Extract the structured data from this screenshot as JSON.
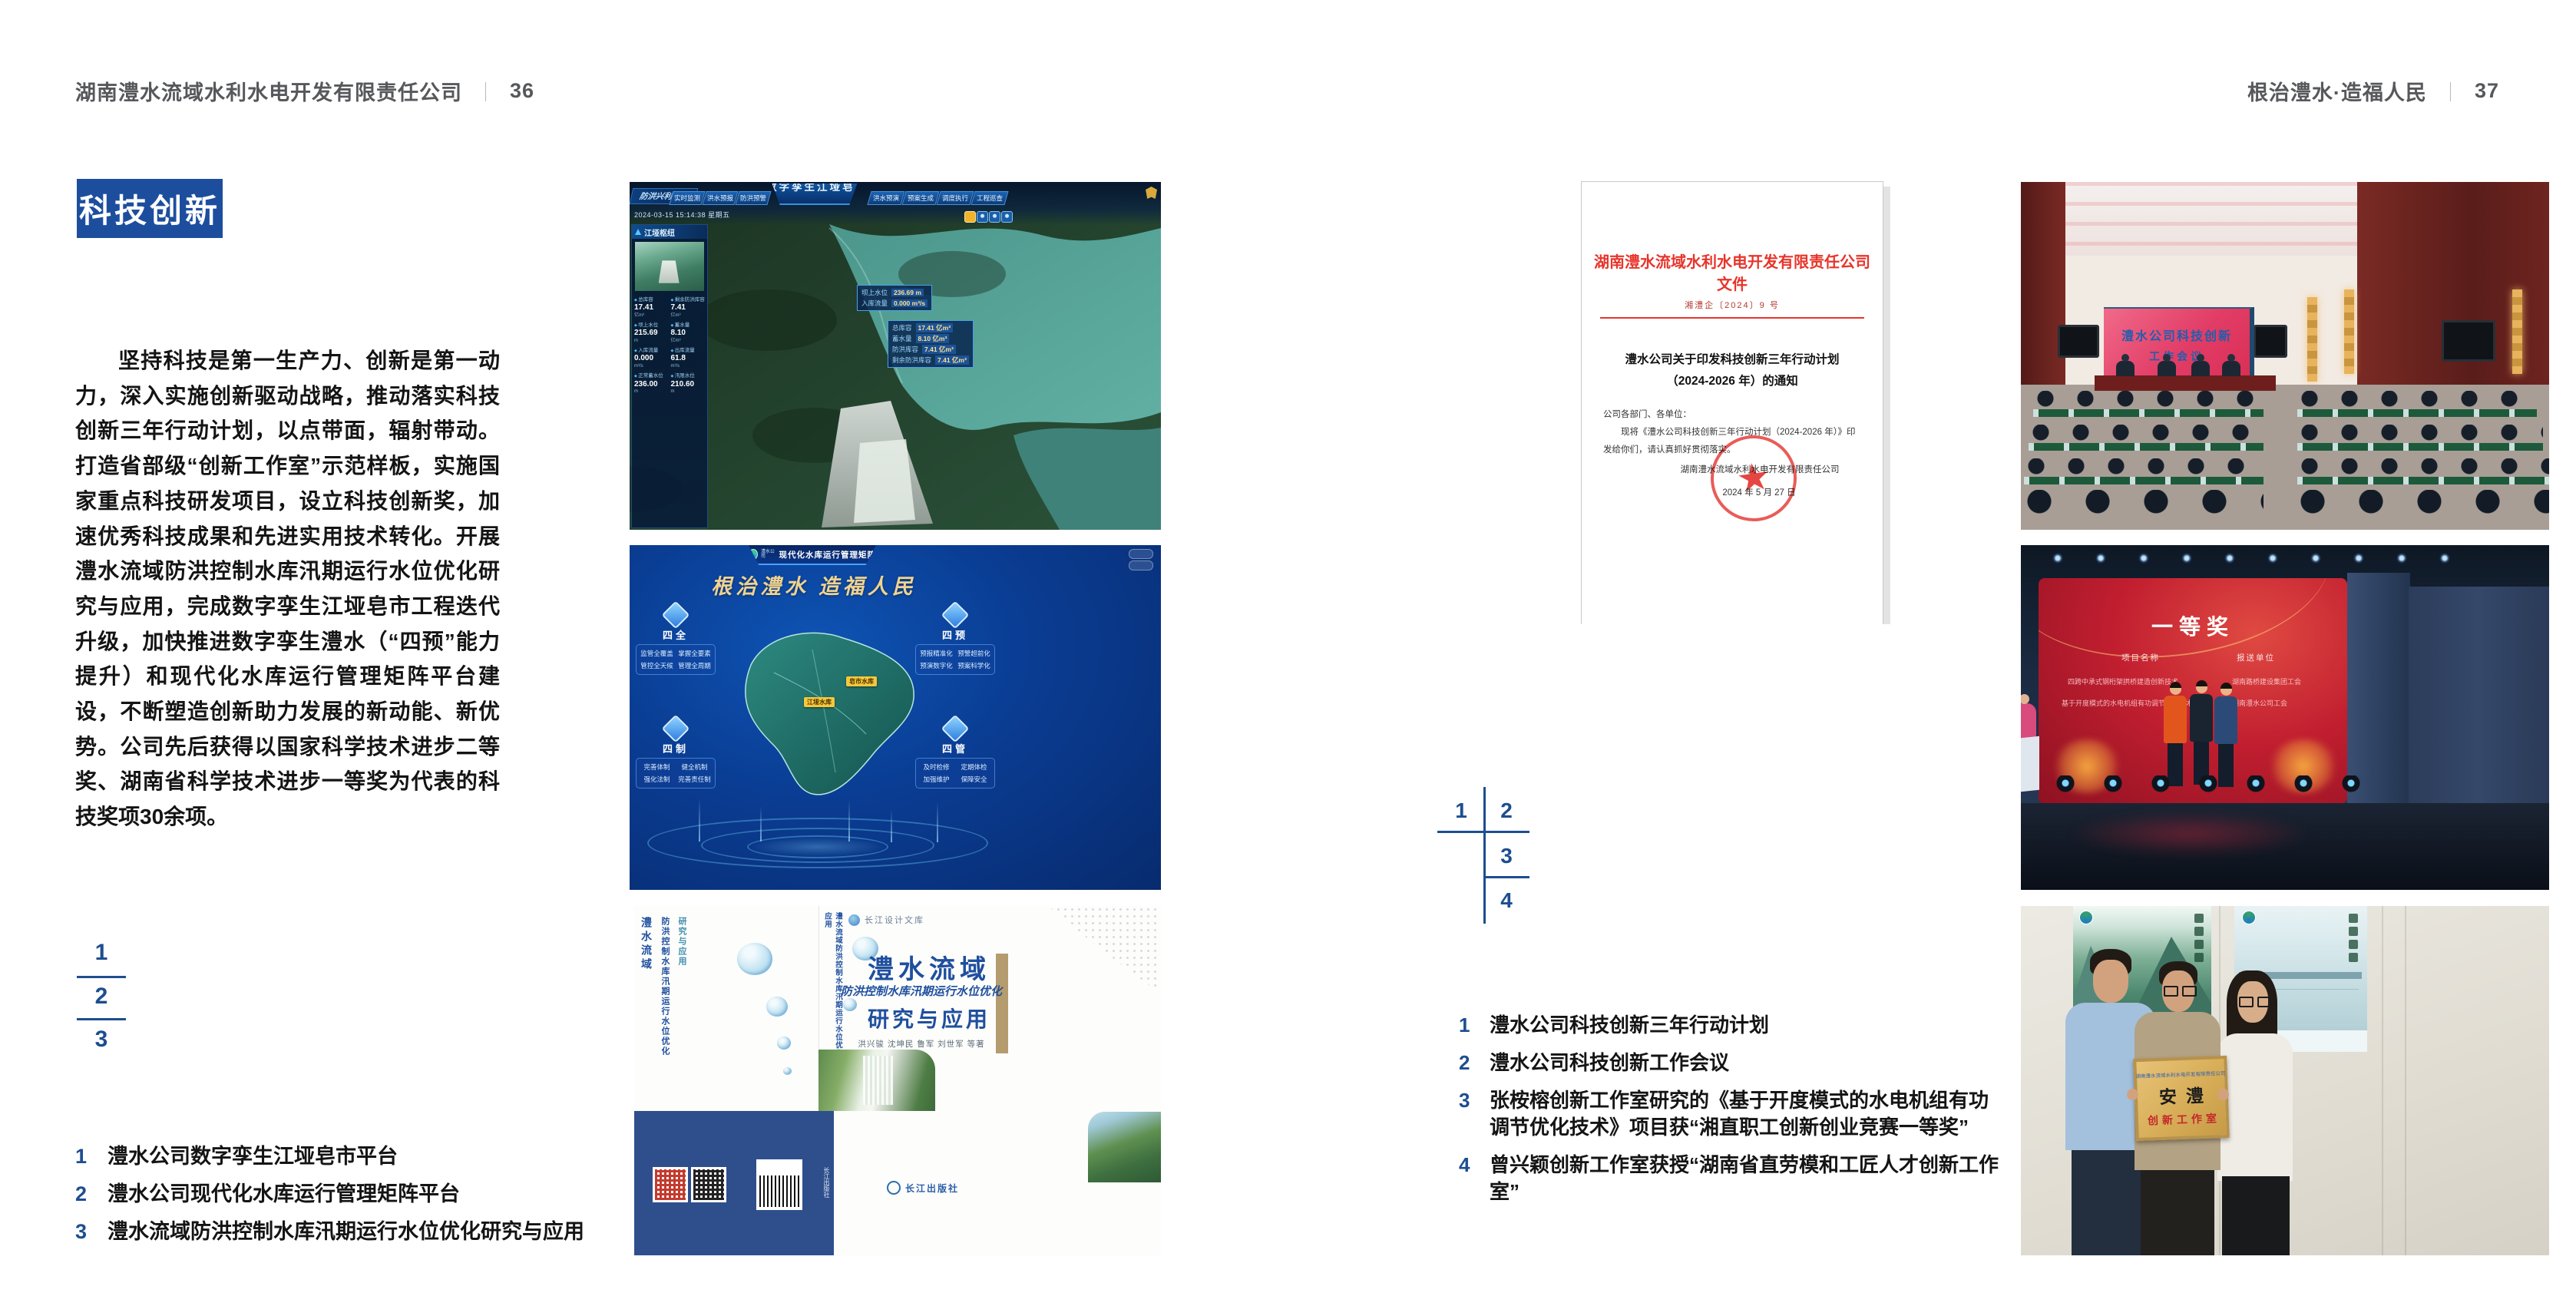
{
  "colors": {
    "accent_blue": "#1d4e9e",
    "index_blue": "#1d4e8f",
    "doc_red": "#e8342a",
    "matrix_gold": "#efd391"
  },
  "header_left": {
    "title": "湖南澧水流域水利水电开发有限责任公司",
    "sep": "｜",
    "page_no": "36"
  },
  "header_right": {
    "title": "根治澧水·造福人民",
    "sep": "｜",
    "page_no": "37"
  },
  "left_page": {
    "section_title": "科技创新",
    "body": "坚持科技是第一生产力、创新是第一动力，深入实施创新驱动战略，推动落实科技创新三年行动计划，以点带面，辐射带动。打造省部级“创新工作室”示范样板，实施国家重点科技研发项目，设立科技创新奖，加速优秀科技成果和先进实用技术转化。开展澧水流域防洪控制水库汛期运行水位优化研究与应用，完成数字孪生江垭皂市工程迭代升级，加快推进数字孪生澧水（“四预”能力提升）和现代化水库运行管理矩阵平台建设，不断塑造创新助力发展的新动能、新优势。公司先后获得以国家科学技术进步二等奖、湖南省科学技术进步一等奖为代表的科技奖项30余项。",
    "index": [
      "1",
      "2",
      "3"
    ],
    "captions": [
      {
        "num": "1",
        "text": "澧水公司数字孪生江垭皂市平台"
      },
      {
        "num": "2",
        "text": "澧水公司现代化水库运行管理矩阵平台"
      },
      {
        "num": "3",
        "text": "澧水流域防洪控制水库汛期运行水位优化研究与应用"
      }
    ]
  },
  "right_page": {
    "index": [
      "1",
      "2",
      "3",
      "4"
    ],
    "captions": [
      {
        "num": "1",
        "text": "澧水公司科技创新三年行动计划"
      },
      {
        "num": "2",
        "text": "澧水公司科技创新工作会议"
      },
      {
        "num": "3",
        "text": "张桉榕创新工作室研究的《基于开度模式的水电机组有功调节优化技术》项目获“湘直职工创新创业竞赛一等奖”"
      },
      {
        "num": "4",
        "text": "曾兴颖创新工作室获授“湖南省直劳模和工匠人才创新工作室”"
      }
    ]
  },
  "dashboard": {
    "corner_label": "防洪兴利调度",
    "title": "数字孪生江垭皂市",
    "tabs_left": [
      "实时监测",
      "洪水预报",
      "防洪预警"
    ],
    "tabs_right": [
      "洪水预演",
      "预案生成",
      "调度执行",
      "工程巡查"
    ],
    "datetime": "2024-03-15 15:14:38 星期五",
    "panel_title": "江垭枢纽",
    "stats": [
      {
        "label": "总库容",
        "value": "17.41",
        "unit": "亿m³"
      },
      {
        "label": "剩余防洪库容",
        "value": "7.41",
        "unit": "亿m³"
      },
      {
        "label": "坝上水位",
        "value": "215.69",
        "unit": "m"
      },
      {
        "label": "蓄水量",
        "value": "8.10",
        "unit": "亿m³"
      },
      {
        "label": "入库流量",
        "value": "0.000",
        "unit": "m³/s"
      },
      {
        "label": "出库流量",
        "value": "61.8",
        "unit": "m³/s"
      },
      {
        "label": "正常蓄水位",
        "value": "236.00",
        "unit": "m"
      },
      {
        "label": "汛限水位",
        "value": "210.60",
        "unit": "m"
      }
    ],
    "tip_water": [
      {
        "label": "坝上水位",
        "value": "236.69 m"
      },
      {
        "label": "入库流量",
        "value": "0.000 m³/s"
      }
    ],
    "tip_capacity": [
      {
        "label": "总库容",
        "value": "17.41 亿m³"
      },
      {
        "label": "蓄水量",
        "value": "8.10 亿m³"
      },
      {
        "label": "防洪库容",
        "value": "7.41 亿m³"
      },
      {
        "label": "剩余防洪库容",
        "value": "7.41 亿m³"
      }
    ]
  },
  "matrix": {
    "company": "澧水公司",
    "title": "现代化水库运行管理矩阵",
    "slogan": "根治澧水 造福人民",
    "groups": [
      {
        "name": "四全",
        "items": [
          "监管全覆盖",
          "掌握全要素",
          "管控全天候",
          "管理全周期"
        ]
      },
      {
        "name": "四预",
        "items": [
          "预报精准化",
          "预警超前化",
          "预演数字化",
          "预案科学化"
        ]
      },
      {
        "name": "四制",
        "items": [
          "完善体制",
          "健全机制",
          "强化法制",
          "完善责任制"
        ]
      },
      {
        "name": "四管",
        "items": [
          "及时检修",
          "定期体检",
          "加强维护",
          "保障安全"
        ]
      }
    ],
    "label_zaoshi": "皂市水库",
    "label_jiangya": "江垭水库"
  },
  "book": {
    "series": "长江设计文库",
    "title_main": "澧水流域",
    "title_sub": "防洪控制水库汛期运行水位优化",
    "title_tail": "研究与应用",
    "authors": "洪兴骏 沈坤民 鲁军 刘世军 等著",
    "publisher": "长江出版社",
    "spine": "澧水流域防洪控制水库汛期运行水位优化研究与应用"
  },
  "document": {
    "header": "湖南澧水流域水利水电开发有限责任公司文件",
    "doc_no": "湘澧企〔2024〕9 号",
    "title_line1": "澧水公司关于印发科技创新三年行动计划",
    "title_line2": "（2024-2026 年）的通知",
    "salutation": "公司各部门、各单位：",
    "body": "现将《澧水公司科技创新三年行动计划（2024-2026 年）》印发给你们，请认真抓好贯彻落实。",
    "signer": "湖南澧水流域水利水电开发有限责任公司",
    "date": "2024 年 5 月 27 日"
  },
  "meeting": {
    "screen_line1": "澧水公司科技创新",
    "screen_line2": "工作会议"
  },
  "award": {
    "title": "一等奖",
    "col1_header": "项目名称",
    "col2_header": "报送单位",
    "rows": [
      {
        "project": "四跨中承式钢桁架拱桥建造创新技术",
        "org": "湖南路桥建设集团工会"
      },
      {
        "project": "基于开度模式的水电机组有功调节优化技术",
        "org": "湖南澧水公司工会"
      }
    ]
  },
  "plaque": {
    "org_line": "湖南澧水流域水利水电开发有限责任公司",
    "name": "安澧",
    "label": "创新工作室"
  }
}
